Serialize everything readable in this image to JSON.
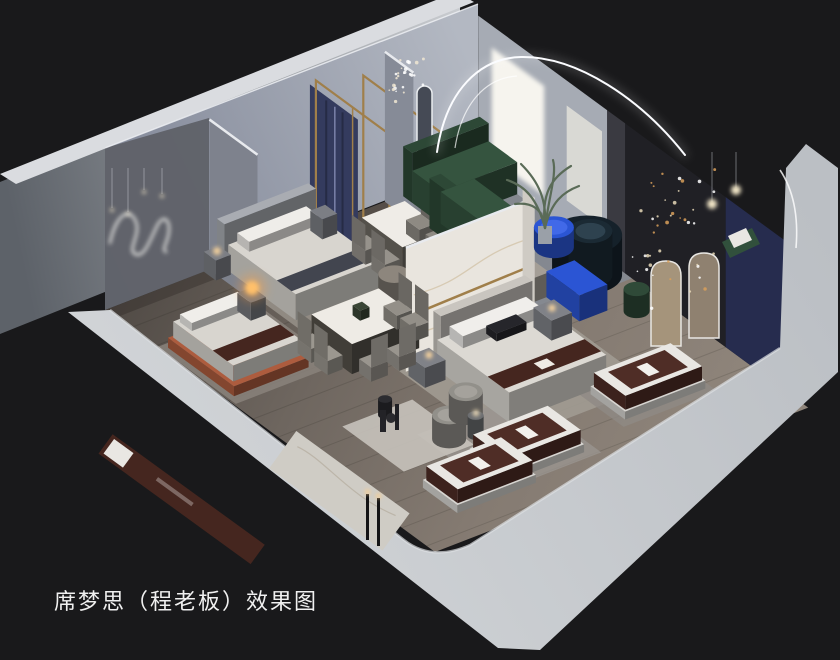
{
  "caption": {
    "text": "席梦思（程老板）效果图"
  },
  "palette": {
    "background": "#19191b",
    "frontWall": "#c6c9cd",
    "frontWallLight": "#d3d6d9",
    "outerWallDark": "#5d6269",
    "outerWallLight": "#c9ccd0",
    "wallTopEdge": "#dadce0",
    "innerWallLeft": "#7f8596",
    "innerWallRight": "#b3b8c2",
    "room1Wall": "#5f6168",
    "floorDark": "#4f4944",
    "floorMid": "#6e665f",
    "floorLight": "#8f857b",
    "ledStrip": "#fbfcff",
    "fairyGold": "#d9a05a",
    "marble": "#e9e5de",
    "goldTrim": "#a07f4a",
    "navyPanel": "#343b5e",
    "accentWallDark": "#202025",
    "accentWallNavy": "#262c4e",
    "windowGlow": "#f6f4ee",
    "sofaGreen": "#35543f",
    "sofaNavy": "#15212a",
    "cobaltBlue": "#2b55d4",
    "mattressBrown": "#4f2d26",
    "mattressWhite": "#e9e7e3",
    "beddingWhite": "#dcd9d3",
    "runnerBrown": "#45261f",
    "bedOrange": "#ad5c3e",
    "lampWarm": "#ffc06a",
    "captionColor": "#f0f0f0"
  },
  "scene": {
    "width": 840,
    "height": 660,
    "origin": {
      "x": 105,
      "y": 310
    },
    "axisA": {
      "x": 0.933,
      "y": -0.361
    },
    "axisB": {
      "x": 0.75,
      "y": 0.55
    },
    "items": [
      {
        "t": "flat",
        "n": "wood-floor",
        "u0": 0,
        "v0": 0,
        "u1": 400,
        "v1": 440,
        "c": "url(#gfloor)"
      },
      {
        "t": "planks",
        "n": "floor-planks"
      },
      {
        "t": "flat",
        "n": "wall-shadow",
        "u0": 0,
        "v0": 0,
        "u1": 400,
        "v1": 14,
        "c": "#2a2622",
        "o": 0.35
      },
      {
        "t": "flat",
        "n": "rug-bedroom2",
        "u0": 118,
        "v0": 4,
        "u1": 240,
        "v1": 118,
        "c": "#989289",
        "o": 0.85
      },
      {
        "t": "flat",
        "n": "rug-dining-1",
        "u0": 228,
        "v0": 30,
        "u1": 305,
        "v1": 128,
        "c": "#a39c93",
        "o": 0.9
      },
      {
        "t": "flat",
        "n": "rug-living",
        "u0": 302,
        "v0": 12,
        "u1": 400,
        "v1": 205,
        "c": "#858b93",
        "o": 0.9
      },
      {
        "t": "flat",
        "n": "rug-bedroom3",
        "u0": 148,
        "v0": 200,
        "u1": 312,
        "v1": 342,
        "c": "#a19b92",
        "o": 0.9
      },
      {
        "t": "flat",
        "n": "rug-bedroom1",
        "u0": 2,
        "v0": 68,
        "u1": 112,
        "v1": 172,
        "c": "#8a837b",
        "o": 0.85
      },
      {
        "t": "flat",
        "n": "rug-front-display",
        "u0": 100,
        "v0": 292,
        "u1": 212,
        "v1": 398,
        "c": "#9a9590",
        "o": 0.8
      },
      {
        "t": "flat",
        "n": "rug-mattress-2",
        "u0": 252,
        "v0": 302,
        "u1": 352,
        "v1": 378,
        "c": "#8e8a85",
        "o": 0.8
      },
      {
        "t": "flat",
        "n": "marble-floor-patch",
        "u0": 55,
        "v0": 248,
        "u1": 130,
        "v1": 330,
        "c": "#c6c2bb",
        "o": 0.9
      },
      {
        "t": "panelB",
        "n": "room-divider-wall",
        "u": 112,
        "v0": 0,
        "v1": 64,
        "h": 150,
        "c": "#7e828d",
        "strip": 1
      },
      {
        "t": "panelB",
        "n": "navy-curtain-panels",
        "u": 218,
        "v0": 2,
        "v1": 66,
        "h": 140,
        "z0": 8,
        "c": "#343b5e",
        "seams": 1
      },
      {
        "t": "panelB",
        "n": "gold-frame-1",
        "u": 226,
        "v0": 0,
        "v1": 98,
        "h": 148,
        "stroke": "#a07f4a"
      },
      {
        "t": "panelB",
        "n": "gold-frame-2",
        "u": 264,
        "v0": 16,
        "v1": 118,
        "h": 148,
        "stroke": "#a07f4a"
      },
      {
        "t": "pill",
        "n": "oval-mirror-1",
        "x": 396,
        "y": 90,
        "w": 15,
        "h": 88,
        "c": "#4d525e"
      },
      {
        "t": "pill",
        "n": "oval-mirror-2",
        "x": 417,
        "y": 86,
        "w": 15,
        "h": 84,
        "c": "#454a55"
      },
      {
        "t": "panelB",
        "n": "hall-divider-wall",
        "u": 300,
        "v0": 0,
        "v1": 38,
        "h": 150,
        "c": "#868b97",
        "strip": 1
      },
      {
        "t": "panelB",
        "n": "window-wall",
        "u": 400,
        "v0": 0,
        "v1": 172,
        "h": 150,
        "c": "#a6abb4"
      },
      {
        "t": "panelB",
        "n": "arch-gap-shadow",
        "u": 400,
        "v0": 172,
        "v1": 196,
        "h": 150,
        "c": "#3a3a41"
      },
      {
        "t": "panelB",
        "n": "window-glow-large",
        "u": 400,
        "v0": 18,
        "v1": 88,
        "h": 110,
        "z0": 18,
        "c": "#f6f4ee",
        "glow": 1
      },
      {
        "t": "panelB",
        "n": "window-glow-small",
        "u": 400,
        "v0": 118,
        "v1": 165,
        "h": 95,
        "z0": 30,
        "c": "#e2e0d9",
        "o": 0.85
      },
      {
        "t": "panelB",
        "n": "accent-wall-dark",
        "u": 400,
        "v0": 196,
        "v1": 330,
        "h": 150,
        "c": "#202025"
      },
      {
        "t": "panelB",
        "n": "accent-wall-navy",
        "u": 400,
        "v0": 330,
        "v1": 425,
        "h": 150,
        "c": "#262c4e"
      },
      {
        "t": "arch",
        "n": "arch-mirror-1",
        "x": 651,
        "y": 261,
        "w": 30,
        "h": 85,
        "c": "#a5947b"
      },
      {
        "t": "arch",
        "n": "arch-mirror-2",
        "x": 689,
        "y": 253,
        "w": 30,
        "h": 85,
        "c": "#8f8170"
      },
      {
        "t": "box",
        "n": "bed2-headboard",
        "u0": 120,
        "v0": 0,
        "u1": 218,
        "v1": 10,
        "h": 48,
        "c": "#a9acb2"
      },
      {
        "t": "box",
        "n": "bed2",
        "u0": 124,
        "v0": 10,
        "u1": 214,
        "v1": 100,
        "h": 26,
        "c": "#d8d5cf",
        "stripe": {
          "axis": "v",
          "f0": 0.72,
          "f1": 0.94,
          "c": "#42454f"
        }
      },
      {
        "t": "box",
        "n": "bed2-pillows",
        "u0": 132,
        "v0": 12,
        "u1": 206,
        "v1": 28,
        "h": 10,
        "z0": 26,
        "c": "#efede9"
      },
      {
        "t": "box",
        "n": "nightstand-bed2-left",
        "u0": 106,
        "v0": 0,
        "u1": 122,
        "v1": 16,
        "h": 20,
        "c": "#7c7e84"
      },
      {
        "t": "box",
        "n": "nightstand-bed2-right",
        "u0": 220,
        "v0": 0,
        "u1": 236,
        "v1": 16,
        "h": 20,
        "c": "#7c7e84"
      },
      {
        "t": "glow",
        "n": "lamp-bed2",
        "x": 217,
        "y": 251,
        "r": 4,
        "c": "#ffd9a0",
        "o": 0.9
      },
      {
        "t": "box",
        "n": "dining-table-1",
        "u0": 240,
        "v0": 44,
        "u1": 286,
        "v1": 98,
        "h": 30,
        "c": "#efece7",
        "sc": "#6f6b63"
      },
      {
        "t": "chair",
        "n": "dining1-chair-1",
        "u0": 226,
        "v0": 48,
        "u1": 242,
        "v1": 66,
        "h": 14,
        "bh": 26,
        "side": "u0",
        "c": "#96928b"
      },
      {
        "t": "chair",
        "n": "dining1-chair-2",
        "u0": 226,
        "v0": 74,
        "u1": 242,
        "v1": 92,
        "h": 14,
        "bh": 26,
        "side": "u0",
        "c": "#96928b"
      },
      {
        "t": "chair",
        "n": "dining1-chair-3",
        "u0": 284,
        "v0": 48,
        "u1": 300,
        "v1": 66,
        "h": 14,
        "bh": 26,
        "side": "u1",
        "c": "#8e8a83"
      },
      {
        "t": "chair",
        "n": "dining1-chair-4",
        "u0": 284,
        "v0": 74,
        "u1": 300,
        "v1": 92,
        "h": 14,
        "bh": 26,
        "side": "u1",
        "c": "#8e8a83"
      },
      {
        "t": "box",
        "n": "bed1-frame",
        "u0": 8,
        "v0": 74,
        "u1": 88,
        "v1": 162,
        "h": 10,
        "c": "#ad5c3e"
      },
      {
        "t": "box",
        "n": "bed1",
        "u0": 12,
        "v0": 76,
        "u1": 84,
        "v1": 156,
        "h": 16,
        "z0": 10,
        "c": "#d8d5cf",
        "stripe": {
          "axis": "v",
          "f0": 0.66,
          "f1": 0.9,
          "c": "#45261f"
        }
      },
      {
        "t": "box",
        "n": "bed1-pillows",
        "u0": 16,
        "v0": 80,
        "u1": 78,
        "v1": 96,
        "h": 8,
        "z0": 26,
        "c": "#f0eeea"
      },
      {
        "t": "box",
        "n": "nightstand-bed1",
        "u0": 92,
        "v0": 62,
        "u1": 108,
        "v1": 80,
        "h": 18,
        "c": "#76787d"
      },
      {
        "t": "glow",
        "n": "lamp-orb-halo",
        "x": 252,
        "y": 288,
        "r": 14,
        "c": "#ff9f3d",
        "o": 0.35
      },
      {
        "t": "glow",
        "n": "lamp-orb-bed1",
        "x": 252,
        "y": 288,
        "r": 7,
        "c": "#ffc06a"
      },
      {
        "t": "box",
        "n": "tv-console",
        "u0": 205,
        "v0": 160,
        "u1": 325,
        "v1": 188,
        "h": 24,
        "c": "#a49e96"
      },
      {
        "t": "box",
        "n": "console-decor",
        "u0": 296,
        "v0": 164,
        "u1": 310,
        "v1": 182,
        "h": 14,
        "z0": 24,
        "c": "#2a2a2e"
      },
      {
        "t": "disk",
        "n": "round-coffee-table",
        "u": 220,
        "v": 112,
        "r": 16,
        "h": 18,
        "c": "#8d867d"
      },
      {
        "t": "box",
        "n": "sofa-green-back",
        "u0": 318,
        "v0": 2,
        "u1": 400,
        "v1": 14,
        "h": 50,
        "c": "#2d4836"
      },
      {
        "t": "box",
        "n": "sofa-green-seat",
        "u0": 318,
        "v0": 14,
        "u1": 400,
        "v1": 52,
        "h": 32,
        "c": "#35543f"
      },
      {
        "t": "box",
        "n": "sofa-green-corner-back",
        "u0": 306,
        "v0": 52,
        "u1": 318,
        "v1": 132,
        "h": 50,
        "c": "#2d4836"
      },
      {
        "t": "box",
        "n": "sofa-green-corner-seat",
        "u0": 318,
        "v0": 52,
        "u1": 354,
        "v1": 130,
        "h": 32,
        "c": "#35543f"
      },
      {
        "t": "panelA",
        "n": "marble-feature-wall",
        "v": 212,
        "u0": 152,
        "u1": 290,
        "h": 124,
        "c": "#e9e5de",
        "marble": 1,
        "gold": 1,
        "strip": 1
      },
      {
        "t": "panelB",
        "n": "marble-wall-return",
        "u": 290,
        "v0": 196,
        "v1": 212,
        "h": 124,
        "c": "#cfcbc4"
      },
      {
        "t": "disk",
        "n": "sofa-navy-curved",
        "u": 372,
        "v": 180,
        "r": 35,
        "h": 40,
        "c": "#15212a",
        "top": "#263845"
      },
      {
        "t": "disk",
        "n": "sofa-navy-cushion",
        "u": 374,
        "v": 182,
        "r": 22,
        "h": 44,
        "c": "#1b2a34",
        "top": "#2e424f"
      },
      {
        "t": "disk",
        "n": "coffee-table-blue",
        "u": 375,
        "v": 132,
        "r": 20,
        "h": 20,
        "c": "#2b55d4",
        "top": "#4169e8"
      },
      {
        "t": "box",
        "n": "media-console-blue",
        "u0": 322,
        "v0": 188,
        "u1": 352,
        "v1": 232,
        "h": 26,
        "c": "#2b55d4"
      },
      {
        "t": "disk",
        "n": "accent-chair-green",
        "u": 372,
        "v": 246,
        "r": 13,
        "h": 22,
        "c": "#2f4a38"
      },
      {
        "t": "box",
        "n": "bed3-headboard",
        "u0": 180,
        "v0": 214,
        "u1": 278,
        "v1": 224,
        "h": 52,
        "c": "#c9c5bf"
      },
      {
        "t": "box",
        "n": "bed3",
        "u0": 176,
        "v0": 224,
        "u1": 280,
        "v1": 320,
        "h": 30,
        "c": "#dcd9d3",
        "stripe": {
          "axis": "v",
          "f0": 0.7,
          "f1": 0.93,
          "c": "#45261f",
          "label": 1
        }
      },
      {
        "t": "box",
        "n": "bed3-pillows",
        "u0": 186,
        "v0": 228,
        "u1": 268,
        "v1": 246,
        "h": 12,
        "z0": 30,
        "c": "#f0eeeb"
      },
      {
        "t": "box",
        "n": "bed3-pillow-dark",
        "u0": 214,
        "v0": 242,
        "u1": 246,
        "v1": 256,
        "h": 8,
        "z0": 32,
        "c": "#26262b"
      },
      {
        "t": "box",
        "n": "nightstand-bed3-left",
        "u0": 150,
        "v0": 218,
        "u1": 172,
        "v1": 240,
        "h": 20,
        "c": "#808288"
      },
      {
        "t": "box",
        "n": "nightstand-bed3-right",
        "u0": 284,
        "v0": 218,
        "u1": 306,
        "v1": 242,
        "h": 20,
        "c": "#808288"
      },
      {
        "t": "glow",
        "n": "lamp-bed3-left",
        "x": 429,
        "y": 355,
        "r": 3.5,
        "c": "#ffd9a0"
      },
      {
        "t": "glow",
        "n": "lamp-bed3-right",
        "x": 552,
        "y": 308,
        "r": 3.5,
        "c": "#ffd9a0"
      },
      {
        "t": "box",
        "n": "dining-table-2",
        "u0": 112,
        "v0": 136,
        "u1": 184,
        "v1": 190,
        "h": 30,
        "c": "#eeebe5",
        "sc": "#55514a"
      },
      {
        "t": "box",
        "n": "table2-plant",
        "u0": 140,
        "v0": 156,
        "u1": 150,
        "v1": 166,
        "h": 10,
        "z0": 30,
        "c": "#3a4636"
      },
      {
        "t": "chair",
        "n": "dining2-chair-1",
        "u0": 94,
        "v0": 140,
        "u1": 110,
        "v1": 158,
        "h": 14,
        "bh": 28,
        "side": "u0",
        "c": "#9b978f"
      },
      {
        "t": "chair",
        "n": "dining2-chair-2",
        "u0": 94,
        "v0": 162,
        "u1": 110,
        "v1": 180,
        "h": 14,
        "bh": 28,
        "side": "u0",
        "c": "#9b978f"
      },
      {
        "t": "chair",
        "n": "dining2-chair-3",
        "u0": 186,
        "v0": 140,
        "u1": 202,
        "v1": 158,
        "h": 14,
        "bh": 28,
        "side": "u1",
        "c": "#938f88"
      },
      {
        "t": "chair",
        "n": "dining2-chair-4",
        "u0": 186,
        "v0": 162,
        "u1": 202,
        "v1": 180,
        "h": 14,
        "bh": 28,
        "side": "u1",
        "c": "#938f88"
      },
      {
        "t": "chair",
        "n": "dining2-chair-5",
        "u0": 118,
        "v0": 192,
        "u1": 136,
        "v1": 208,
        "h": 14,
        "bh": 28,
        "side": "v1",
        "c": "#99958e"
      },
      {
        "t": "chair",
        "n": "dining2-chair-6",
        "u0": 148,
        "v0": 192,
        "u1": 166,
        "v1": 208,
        "h": 14,
        "bh": 28,
        "side": "v1",
        "c": "#99958e"
      },
      {
        "t": "disk",
        "n": "swivel-chair-1",
        "u": 118,
        "v": 312,
        "r": 17,
        "h": 24,
        "c": "#92908a",
        "top": "#a5a29c"
      },
      {
        "t": "disk",
        "n": "swivel-chair-2",
        "u": 152,
        "v": 292,
        "r": 17,
        "h": 24,
        "c": "#92908a",
        "top": "#a5a29c"
      },
      {
        "t": "disk",
        "n": "swivel-side-table",
        "u": 140,
        "v": 320,
        "r": 8,
        "h": 20,
        "c": "#6b6d70"
      },
      {
        "t": "glow",
        "n": "swivel-table-lamp",
        "x": 476,
        "y": 413,
        "r": 3,
        "c": "#ffe9c0"
      },
      {
        "t": "disk",
        "n": "decor-vase-dark",
        "u": 96,
        "v": 254,
        "r": 7,
        "h": 16,
        "c": "#2c2c30"
      },
      {
        "t": "box",
        "n": "mattress-2-base",
        "u0": 260,
        "v0": 324,
        "u1": 346,
        "v1": 370,
        "h": 8,
        "c": "#d7d5d1"
      },
      {
        "t": "box",
        "n": "mattress-2",
        "u0": 262,
        "v0": 326,
        "u1": 344,
        "v1": 368,
        "h": 14,
        "z0": 8,
        "c": "#4f2d26",
        "deco": "mattress"
      },
      {
        "t": "box",
        "n": "mattress-1-base",
        "u0": 116,
        "v0": 342,
        "u1": 200,
        "v1": 390,
        "h": 8,
        "c": "#d7d5d1"
      },
      {
        "t": "box",
        "n": "mattress-1",
        "u0": 118,
        "v0": 344,
        "u1": 198,
        "v1": 388,
        "h": 14,
        "z0": 8,
        "c": "#4f2d26",
        "deco": "mattress"
      },
      {
        "t": "box",
        "n": "mattress-3-base",
        "u0": 53,
        "v0": 358,
        "u1": 137,
        "v1": 404,
        "h": 8,
        "c": "#d7d5d1"
      },
      {
        "t": "box",
        "n": "mattress-3",
        "u0": 55,
        "v0": 360,
        "u1": 135,
        "v1": 402,
        "h": 14,
        "z0": 8,
        "c": "#4f2d26",
        "deco": "mattress"
      },
      {
        "t": "dots",
        "n": "fairy-lights-wall",
        "x": 630,
        "y": 160,
        "w": 86,
        "h": 150,
        "n2": 42,
        "c": [
          "#ffffff",
          "#d9a05a",
          "#e8d9b8"
        ]
      },
      {
        "t": "dots",
        "n": "chandelier-crystal",
        "x": 386,
        "y": 56,
        "w": 38,
        "h": 46,
        "n2": 26,
        "c": [
          "#ffffff",
          "#f0e6d2"
        ]
      },
      {
        "t": "pendants",
        "n": "pendant-lights-room1",
        "x": 112,
        "y": 168,
        "xs": [
          0,
          16,
          32,
          50
        ],
        "ls": [
          40,
          44,
          22,
          26
        ]
      },
      {
        "t": "pendants",
        "n": "floor-lamp-spheres",
        "x": 712,
        "y": 152,
        "xs": [
          0,
          24
        ],
        "ls": [
          50,
          36
        ],
        "r": 5
      }
    ]
  }
}
